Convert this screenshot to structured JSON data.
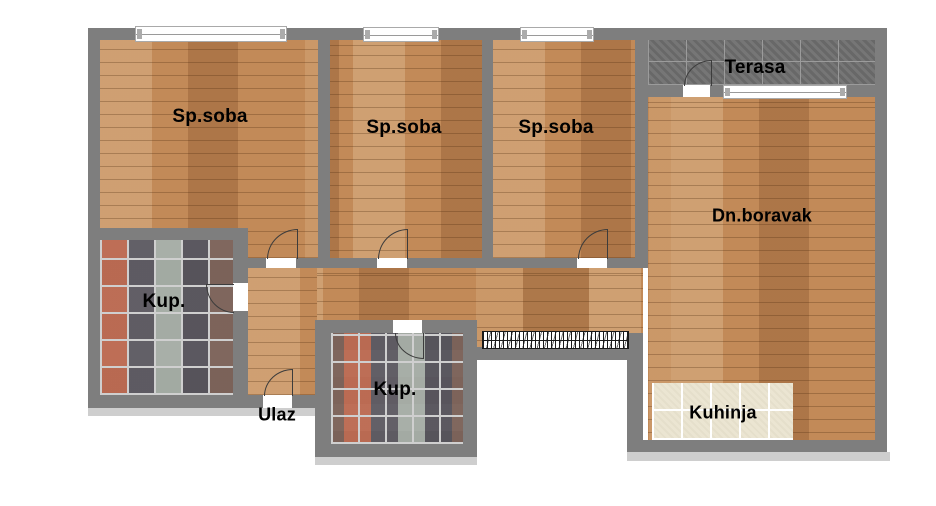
{
  "floorplan": {
    "title": "Apartment floor plan",
    "rooms": [
      {
        "id": "sp_soba_1",
        "label": "Sp.soba",
        "floor": "wood"
      },
      {
        "id": "sp_soba_2",
        "label": "Sp.soba",
        "floor": "wood"
      },
      {
        "id": "sp_soba_3",
        "label": "Sp.soba",
        "floor": "wood"
      },
      {
        "id": "terasa",
        "label": "Terasa",
        "floor": "dark-tile"
      },
      {
        "id": "dn_boravak",
        "label": "Dn.boravak",
        "floor": "wood"
      },
      {
        "id": "kup_1",
        "label": "Kup.",
        "floor": "mosaic-tile"
      },
      {
        "id": "kup_2",
        "label": "Kup.",
        "floor": "mosaic-tile"
      },
      {
        "id": "ulaz",
        "label": "Ulaz",
        "floor": "entrance"
      },
      {
        "id": "kuhinja",
        "label": "Kuhinja",
        "floor": "beige-tile"
      }
    ],
    "colors": {
      "wall": "#7e7e7e",
      "wood": "#c28a58",
      "terrace_tile": "#6f6f6f",
      "kitchen_tile": "#ebe5d2",
      "window_white": "#ffffff",
      "shadow": "#bdbdbd",
      "label_text": "#000000"
    }
  }
}
